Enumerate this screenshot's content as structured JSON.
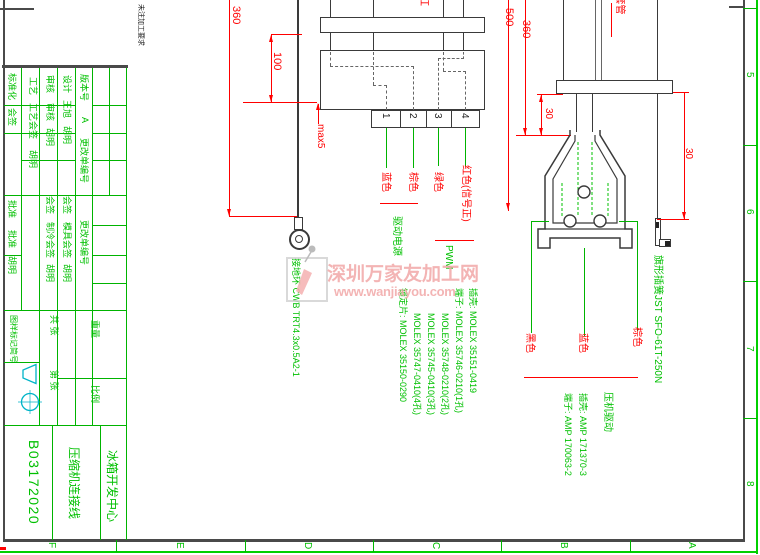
{
  "frame": {
    "right_zones": [
      "5",
      "6",
      "7",
      "8"
    ],
    "bottom_zones": [
      "F",
      "E",
      "D",
      "C",
      "B",
      "A"
    ]
  },
  "note_top_left": "未注加工要求",
  "watermark": {
    "line1": "深圳万家友加工网",
    "line2": "www.wanjiayou.com"
  },
  "title_block": {
    "col1": {
      "standardization": "标准化",
      "countersign": "会签",
      "approve1": "批准",
      "approve2": "批准",
      "name": "胡明"
    },
    "col2": {
      "process": "工艺",
      "process_countersign": "工艺会签",
      "name": "胡明"
    },
    "col3": {
      "check1": "审核",
      "check2": "审核",
      "name1": "胡明",
      "countersign": "会签",
      "cooling_countersign": "制冷会签",
      "name2": "胡明"
    },
    "col4": {
      "design": "设计",
      "designer": "王旭",
      "name1": "胡明",
      "countersign": "会签",
      "mold_countersign": "模具会签",
      "name2": "胡明"
    },
    "col5": {
      "version_label": "版本号",
      "version": "A",
      "change_order1": "更改单编号",
      "change_order2": "更改单编号"
    },
    "mark_label": "图样标记简号",
    "total_sheets": "共  张",
    "sheet_no": "第  张",
    "weight": "重量",
    "scale": "比例",
    "drawing_no": "B03172020",
    "title": "压缩机连接线",
    "org": "冰箱开发中心"
  },
  "dims": {
    "left360": "360",
    "len100": "100",
    "max5": "max5",
    "len500": "500",
    "right360": "360",
    "gap30a": "30",
    "gap30b": "30"
  },
  "ground": {
    "label": "接地环 CWB TRT4.3x0.5A2-1"
  },
  "molex": {
    "fragment": "红",
    "pins": [
      "1",
      "2",
      "3",
      "4"
    ],
    "wires": [
      "蓝色",
      "棕色",
      "绿色",
      "红色(信号正)"
    ],
    "group1": "驱动电源",
    "group2": "PWM",
    "parts": [
      "插壳: MOLEX 35151-0419",
      "端子: MOLEX 35746-0210(1孔)",
      "MOLEX 35748-0210(2孔)",
      "MOLEX 35745-0410(3孔)",
      "MOLEX 35747-0410(4孔)",
      "锁定片: MOLEX 35150-0290"
    ]
  },
  "compressor": {
    "sleeve": "PVC套管",
    "terminal": "旗形插簧JST SFO-61T-250N",
    "wires": [
      "黑色",
      "蓝色",
      "棕色"
    ],
    "group": "压机驱动",
    "parts": [
      "插壳: AMP 171370-3",
      "端子: AMP 170063-2"
    ]
  }
}
